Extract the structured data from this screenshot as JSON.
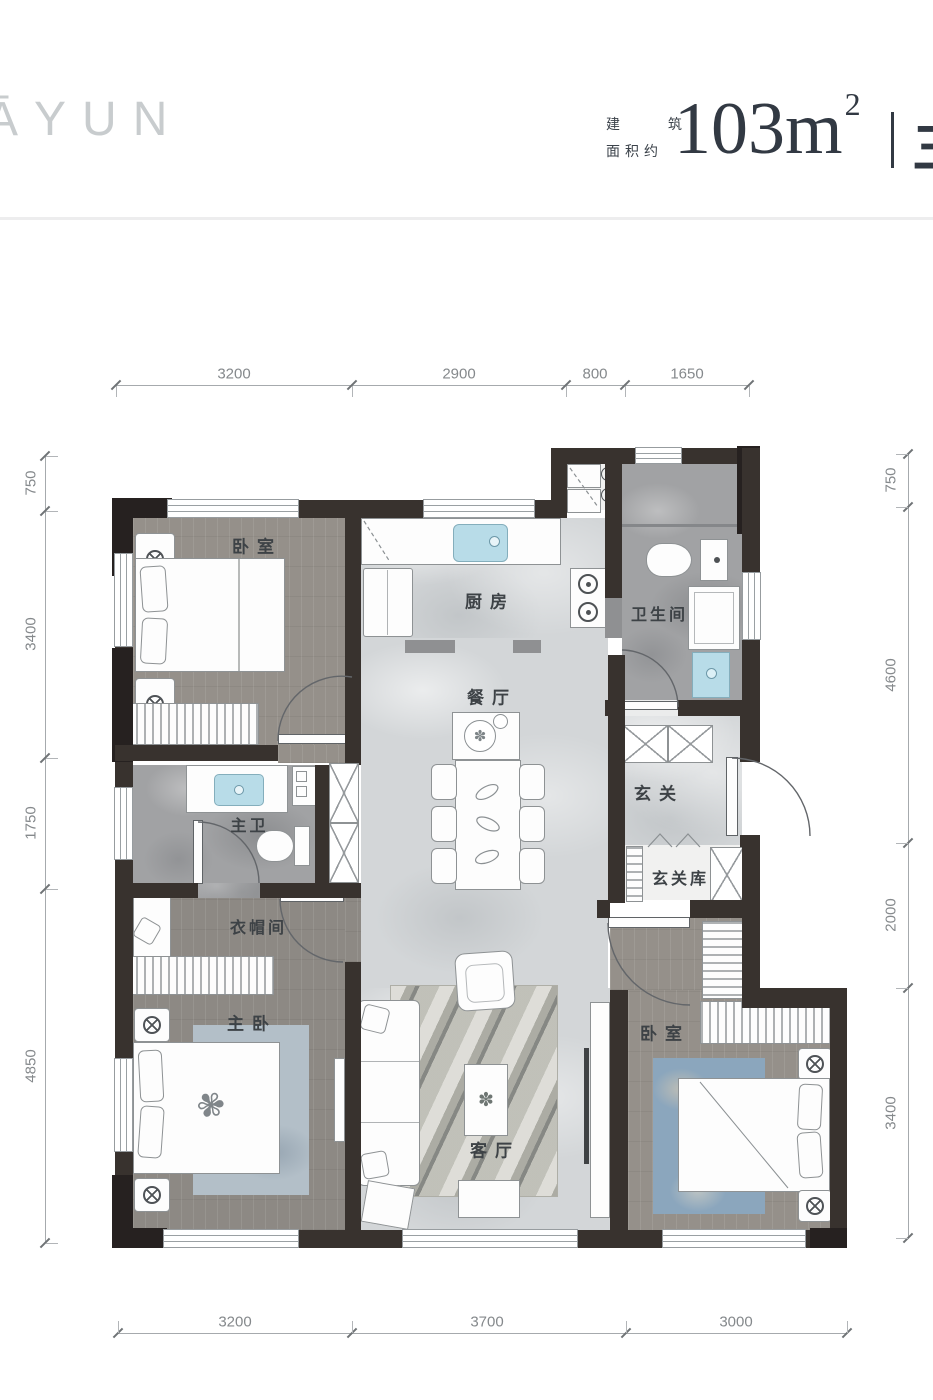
{
  "header": {
    "logo": "ĀYUN",
    "area_label_top": "建 筑",
    "area_label_bottom": "面积约",
    "area_value": "103m",
    "area_sup": "2",
    "separator": "丨",
    "suffix_partial": "三"
  },
  "rooms": {
    "bedroom_top": "卧室",
    "kitchen": "厨房",
    "bathroom": "卫生间",
    "dining": "餐厅",
    "foyer": "玄关",
    "foyer_storage": "玄关库",
    "master_bathroom": "主卫",
    "cloakroom": "衣帽间",
    "master_bedroom": "主卧",
    "living_room": "客厅",
    "bedroom_bottom": "卧室"
  },
  "dimensions": {
    "top": [
      "3200",
      "2900",
      "800",
      "1650"
    ],
    "bottom": [
      "3200",
      "3700",
      "3000"
    ],
    "left": [
      "750",
      "3400",
      "1750",
      "4850"
    ],
    "right": [
      "750",
      "4600",
      "2000",
      "3400"
    ]
  },
  "icons": {
    "plant": "✽",
    "flower": "✾"
  },
  "colors": {
    "wall": "#38322e",
    "wall_corner": "#262120",
    "fixture_blue": "#b8dce8",
    "floor_wood": "#95908a",
    "floor_marble": "#d3d6d8",
    "floor_stone": "#a1a2a4",
    "header_text": "#323943",
    "logo_grey": "#c8ccce"
  }
}
